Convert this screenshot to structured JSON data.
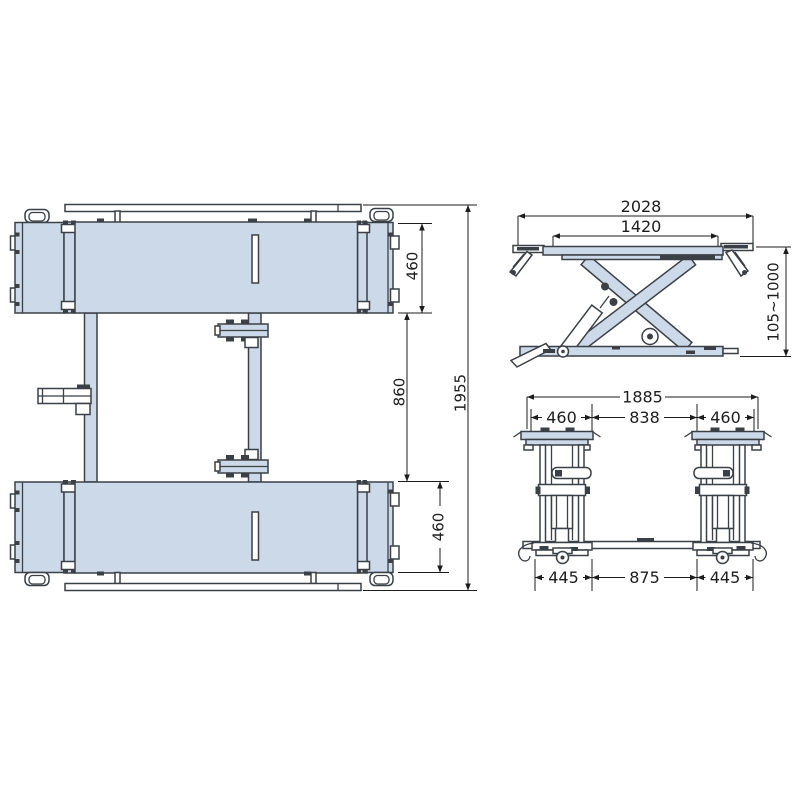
{
  "colors": {
    "part_fill": "#ccd9e8",
    "line": "#3b4046",
    "dim_line": "#1d1d1d",
    "background": "#ffffff"
  },
  "dimensions": {
    "plan_view": {
      "platform_width_top": "460",
      "platform_gap": "860",
      "overall_length": "1955",
      "platform_width_bottom": "460"
    },
    "side_view": {
      "overall_length": "2028",
      "platform_length": "1420",
      "lift_height_range": "105~1000"
    },
    "front_view": {
      "overall_width": "1885",
      "left_platform_width": "460",
      "platform_spacing": "838",
      "right_platform_width": "460",
      "left_base_width": "445",
      "base_spacing": "875",
      "right_base_width": "445"
    }
  }
}
